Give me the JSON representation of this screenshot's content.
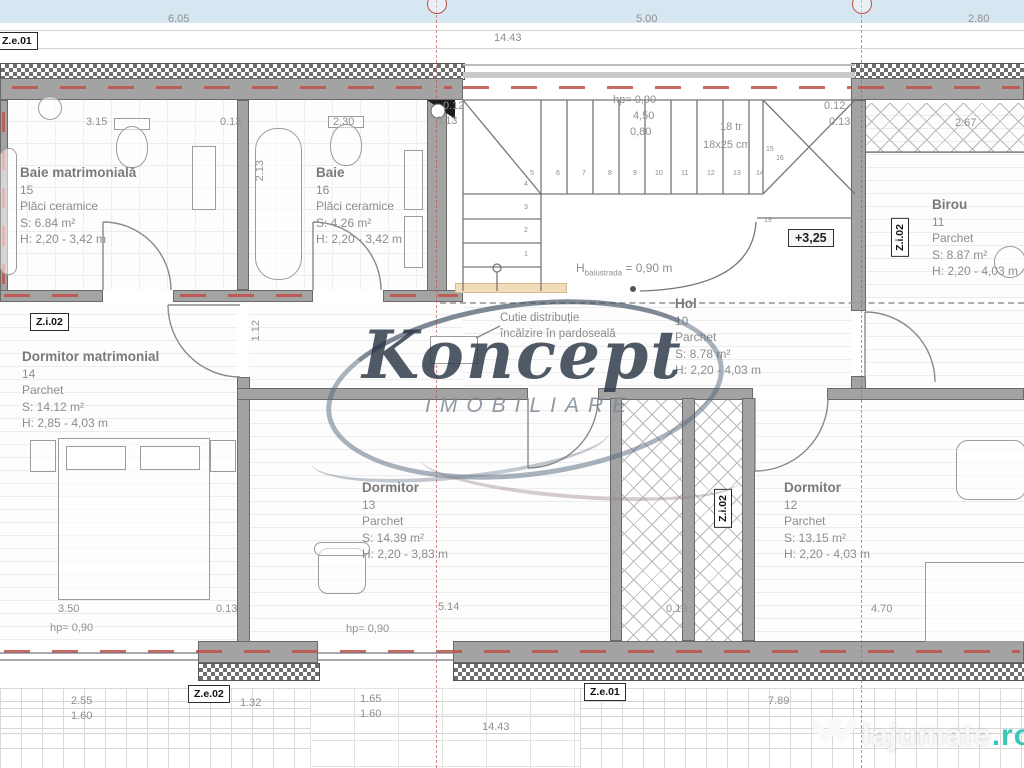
{
  "plan_title": "Etaj / mansarda - plan apartament",
  "watermark": {
    "brand": "Koncept",
    "subtitle": "IMOBILIARE",
    "site": "lajumate",
    "site_tld": ".ro"
  },
  "notes": {
    "line1": "Cutie distribuție",
    "line2": "încălzire în pardoseală"
  },
  "stair": {
    "level": "+3,25",
    "balustrade": {
      "pre": "H",
      "sub": "balustrada",
      "post": " = 0,90 m"
    },
    "texts": [
      {
        "text": "hp=  0,90",
        "x": 613,
        "y": 94
      },
      {
        "text": "4,50",
        "x": 633,
        "y": 110
      },
      {
        "text": "0,80",
        "x": 630,
        "y": 126
      },
      {
        "text": "18 tr",
        "x": 720,
        "y": 121
      },
      {
        "text": "18x25 cm",
        "x": 703,
        "y": 139
      }
    ],
    "steps": [
      {
        "n": "1",
        "x": 524,
        "y": 251
      },
      {
        "n": "2",
        "x": 524,
        "y": 227
      },
      {
        "n": "3",
        "x": 524,
        "y": 204
      },
      {
        "n": "4",
        "x": 524,
        "y": 181
      },
      {
        "n": "5",
        "x": 530,
        "y": 170
      },
      {
        "n": "6",
        "x": 556,
        "y": 170
      },
      {
        "n": "7",
        "x": 582,
        "y": 170
      },
      {
        "n": "8",
        "x": 608,
        "y": 170
      },
      {
        "n": "9",
        "x": 633,
        "y": 170
      },
      {
        "n": "10",
        "x": 655,
        "y": 170
      },
      {
        "n": "11",
        "x": 681,
        "y": 170
      },
      {
        "n": "12",
        "x": 707,
        "y": 170
      },
      {
        "n": "13",
        "x": 733,
        "y": 170
      },
      {
        "n": "14",
        "x": 756,
        "y": 170
      },
      {
        "n": "15",
        "x": 766,
        "y": 146
      },
      {
        "n": "16",
        "x": 776,
        "y": 155
      },
      {
        "n": "19",
        "x": 764,
        "y": 217
      }
    ]
  },
  "rooms": [
    {
      "name": "Baie matrimonială",
      "number": "15",
      "floor": "Plăci ceramice",
      "area": "S: 6.84 m²",
      "height": "H: 2,20 - 3,42 m",
      "x": 20,
      "y": 165
    },
    {
      "name": "Baie",
      "number": "16",
      "floor": "Plăci ceramice",
      "area": "S: 4.26 m²",
      "height": "H: 2,20 - 3,42 m",
      "x": 316,
      "y": 165
    },
    {
      "name": "Birou",
      "number": "11",
      "floor": "Parchet",
      "area": "S: 8.87 m²",
      "height": "H: 2,20 - 4,03 m",
      "x": 932,
      "y": 197
    },
    {
      "name": "Hol",
      "number": "10",
      "floor": "Parchet",
      "area": "S: 8.78 m²",
      "height": "H: 2,20 - 4,03 m",
      "x": 675,
      "y": 296
    },
    {
      "name": "Dormitor matrimonial",
      "number": "14",
      "floor": "Parchet",
      "area": "S: 14.12 m²",
      "height": "H: 2,85 - 4,03 m",
      "x": 22,
      "y": 349
    },
    {
      "name": "Dormitor",
      "number": "13",
      "floor": "Parchet",
      "area": "S: 14.39 m²",
      "height": "H: 2,20 - 3,83 m",
      "x": 362,
      "y": 480
    },
    {
      "name": "Dormitor",
      "number": "12",
      "floor": "Parchet",
      "area": "S: 13.15 m²",
      "height": "H: 2,20 - 4,03 m",
      "x": 784,
      "y": 480
    }
  ],
  "dimensions": [
    {
      "text": "6.05",
      "x": 168,
      "y": 13
    },
    {
      "text": "14.43",
      "x": 494,
      "y": 32
    },
    {
      "text": "5.00",
      "x": 636,
      "y": 13
    },
    {
      "text": "2.80",
      "x": 968,
      "y": 13
    },
    {
      "text": "3.15",
      "x": 86,
      "y": 116
    },
    {
      "text": "0.13",
      "x": 220,
      "y": 116
    },
    {
      "text": "2.30",
      "x": 333,
      "y": 116
    },
    {
      "text": "0.12",
      "x": 443,
      "y": 100
    },
    {
      "text": "0.13",
      "x": 436,
      "y": 115
    },
    {
      "text": "0.12",
      "x": 824,
      "y": 100
    },
    {
      "text": "0.13",
      "x": 829,
      "y": 116
    },
    {
      "text": "2.67",
      "x": 955,
      "y": 117
    },
    {
      "text": "2.13",
      "x": 254,
      "y": 160,
      "vertical": true
    },
    {
      "text": "1.12",
      "x": 250,
      "y": 320,
      "vertical": true
    },
    {
      "text": "3.50",
      "x": 58,
      "y": 603
    },
    {
      "text": "hp=  0,90",
      "x": 50,
      "y": 622
    },
    {
      "text": "0.13",
      "x": 216,
      "y": 603
    },
    {
      "text": "5.14",
      "x": 438,
      "y": 601
    },
    {
      "text": "hp=  0,90",
      "x": 346,
      "y": 623
    },
    {
      "text": "0.13",
      "x": 666,
      "y": 603
    },
    {
      "text": "4.70",
      "x": 871,
      "y": 603
    },
    {
      "text": "2.55",
      "x": 71,
      "y": 695
    },
    {
      "text": "1.60",
      "x": 71,
      "y": 710
    },
    {
      "text": "1.32",
      "x": 240,
      "y": 697
    },
    {
      "text": "1.65",
      "x": 360,
      "y": 693
    },
    {
      "text": "1.60",
      "x": 360,
      "y": 708
    },
    {
      "text": "14.43",
      "x": 482,
      "y": 721
    },
    {
      "text": "7.89",
      "x": 768,
      "y": 695
    }
  ],
  "zone_labels": [
    {
      "text": "Z.e.01",
      "x": -4,
      "y": 32
    },
    {
      "text": "Z.i.02",
      "x": 30,
      "y": 313
    },
    {
      "text": "Z.i.02",
      "x": 891,
      "y": 218,
      "vertical": true
    },
    {
      "text": "Z.i.02",
      "x": 714,
      "y": 489,
      "vertical": true
    },
    {
      "text": "Z.e.02",
      "x": 188,
      "y": 685
    },
    {
      "text": "Z.e.01",
      "x": 584,
      "y": 683
    }
  ]
}
